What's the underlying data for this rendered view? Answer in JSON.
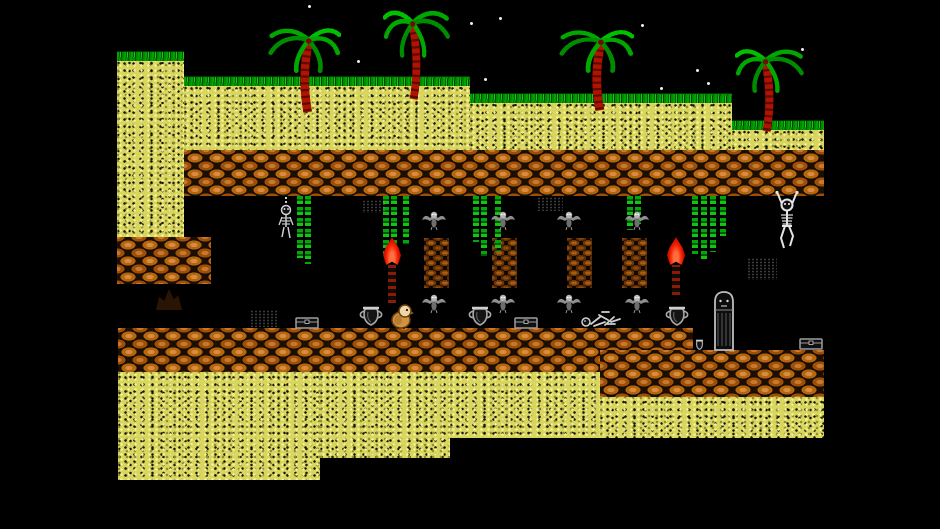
{
  "scene": {
    "kind": "retro-platformer-level",
    "width": 940,
    "height": 529,
    "background": "#000000",
    "visible_text": []
  },
  "palette": {
    "sky": "#000000",
    "star": "#ededed",
    "sand": "#d8d65e",
    "sand_light": "#f8f59a",
    "grass": "#00a400",
    "brick": "#c9772b",
    "brick_dark": "#1c0e02",
    "pillar": "#8a4a10",
    "palm_leaf": "#00a800",
    "palm_trunk": "#b01400",
    "torch_flame": "#f32000",
    "vine": "#00a80a",
    "bone_gray": "#cfcfcf",
    "item_gray": "#a8a8a8",
    "player_body": "#cf9440",
    "player_head": "#efd6a8"
  },
  "stars": [
    [
      308,
      5
    ],
    [
      357,
      60
    ],
    [
      470,
      22
    ],
    [
      499,
      17
    ],
    [
      484,
      78
    ],
    [
      641,
      24
    ],
    [
      660,
      87
    ],
    [
      696,
      69
    ],
    [
      707,
      82
    ],
    [
      801,
      48
    ]
  ],
  "terrain": {
    "sand_blocks": [
      {
        "x": 117,
        "y": 58,
        "w": 67,
        "h": 179
      },
      {
        "x": 184,
        "y": 83,
        "w": 286,
        "h": 67
      },
      {
        "x": 470,
        "y": 100,
        "w": 262,
        "h": 50
      },
      {
        "x": 732,
        "y": 127,
        "w": 92,
        "h": 23
      },
      {
        "x": 118,
        "y": 372,
        "w": 202,
        "h": 108
      },
      {
        "x": 320,
        "y": 372,
        "w": 130,
        "h": 86
      },
      {
        "x": 450,
        "y": 372,
        "w": 150,
        "h": 66
      },
      {
        "x": 600,
        "y": 397,
        "w": 224,
        "h": 41
      }
    ],
    "grass_strips": [
      {
        "x": 117,
        "y": 51,
        "w": 67
      },
      {
        "x": 184,
        "y": 76,
        "w": 286
      },
      {
        "x": 470,
        "y": 93,
        "w": 262
      },
      {
        "x": 732,
        "y": 120,
        "w": 92
      }
    ],
    "brick_blocks": [
      {
        "x": 184,
        "y": 150,
        "w": 640,
        "h": 46
      },
      {
        "x": 117,
        "y": 237,
        "w": 94,
        "h": 47
      },
      {
        "x": 118,
        "y": 328,
        "w": 575,
        "h": 44
      },
      {
        "x": 600,
        "y": 350,
        "w": 224,
        "h": 47
      }
    ],
    "pillars": [
      {
        "x": 424,
        "y": 238,
        "w": 25,
        "h": 50
      },
      {
        "x": 492,
        "y": 238,
        "w": 25,
        "h": 50
      },
      {
        "x": 567,
        "y": 238,
        "w": 25,
        "h": 50
      },
      {
        "x": 622,
        "y": 238,
        "w": 25,
        "h": 50
      }
    ],
    "stalagmites": [
      {
        "x": 156,
        "y": 286,
        "w": 26,
        "h": 24
      }
    ]
  },
  "palms": [
    {
      "x": 265,
      "y": 24,
      "w": 76,
      "h": 90,
      "mirror": false
    },
    {
      "x": 383,
      "y": 6,
      "w": 70,
      "h": 95,
      "mirror": true
    },
    {
      "x": 556,
      "y": 26,
      "w": 78,
      "h": 86,
      "mirror": false
    },
    {
      "x": 735,
      "y": 45,
      "w": 72,
      "h": 88,
      "mirror": true
    }
  ],
  "vines": [
    {
      "x": 297,
      "len": 62
    },
    {
      "x": 305,
      "len": 68
    },
    {
      "x": 383,
      "len": 58
    },
    {
      "x": 391,
      "len": 66
    },
    {
      "x": 403,
      "len": 48
    },
    {
      "x": 473,
      "len": 46
    },
    {
      "x": 481,
      "len": 60
    },
    {
      "x": 495,
      "len": 56
    },
    {
      "x": 627,
      "len": 34
    },
    {
      "x": 635,
      "len": 28
    },
    {
      "x": 692,
      "len": 58
    },
    {
      "x": 701,
      "len": 66
    },
    {
      "x": 710,
      "len": 56
    },
    {
      "x": 720,
      "len": 40
    }
  ],
  "vine_top": 196,
  "torches": [
    {
      "x": 383,
      "flame_y": 237,
      "pole_h": 38
    },
    {
      "x": 667,
      "flame_y": 237,
      "pole_h": 30
    }
  ],
  "bats": [
    {
      "x": 421,
      "y": 210
    },
    {
      "x": 490,
      "y": 210
    },
    {
      "x": 556,
      "y": 210
    },
    {
      "x": 624,
      "y": 210
    },
    {
      "x": 421,
      "y": 293
    },
    {
      "x": 490,
      "y": 293
    },
    {
      "x": 556,
      "y": 293
    },
    {
      "x": 624,
      "y": 293
    }
  ],
  "hanging_skeletons": [
    {
      "type": "chained",
      "x": 273,
      "y": 197
    },
    {
      "type": "climbing",
      "x": 770,
      "y": 190
    }
  ],
  "dust_patches": [
    {
      "x": 362,
      "y": 200,
      "w": 24,
      "h": 13
    },
    {
      "x": 537,
      "y": 197,
      "w": 26,
      "h": 14
    },
    {
      "x": 747,
      "y": 258,
      "w": 30,
      "h": 22
    },
    {
      "x": 250,
      "y": 310,
      "w": 28,
      "h": 17
    }
  ],
  "items": [
    {
      "type": "chest",
      "x": 295,
      "y": 316
    },
    {
      "type": "urn",
      "x": 357,
      "y": 305
    },
    {
      "type": "urn",
      "x": 466,
      "y": 305
    },
    {
      "type": "chest",
      "x": 514,
      "y": 316
    },
    {
      "type": "bones",
      "x": 581,
      "y": 306
    },
    {
      "type": "urn",
      "x": 663,
      "y": 305
    },
    {
      "type": "urn_small",
      "x": 694,
      "y": 339
    },
    {
      "type": "sarcophagus",
      "x": 711,
      "y": 290
    },
    {
      "type": "chest",
      "x": 799,
      "y": 337
    }
  ],
  "player": {
    "x": 390,
    "y": 303,
    "w": 24,
    "h": 26
  }
}
